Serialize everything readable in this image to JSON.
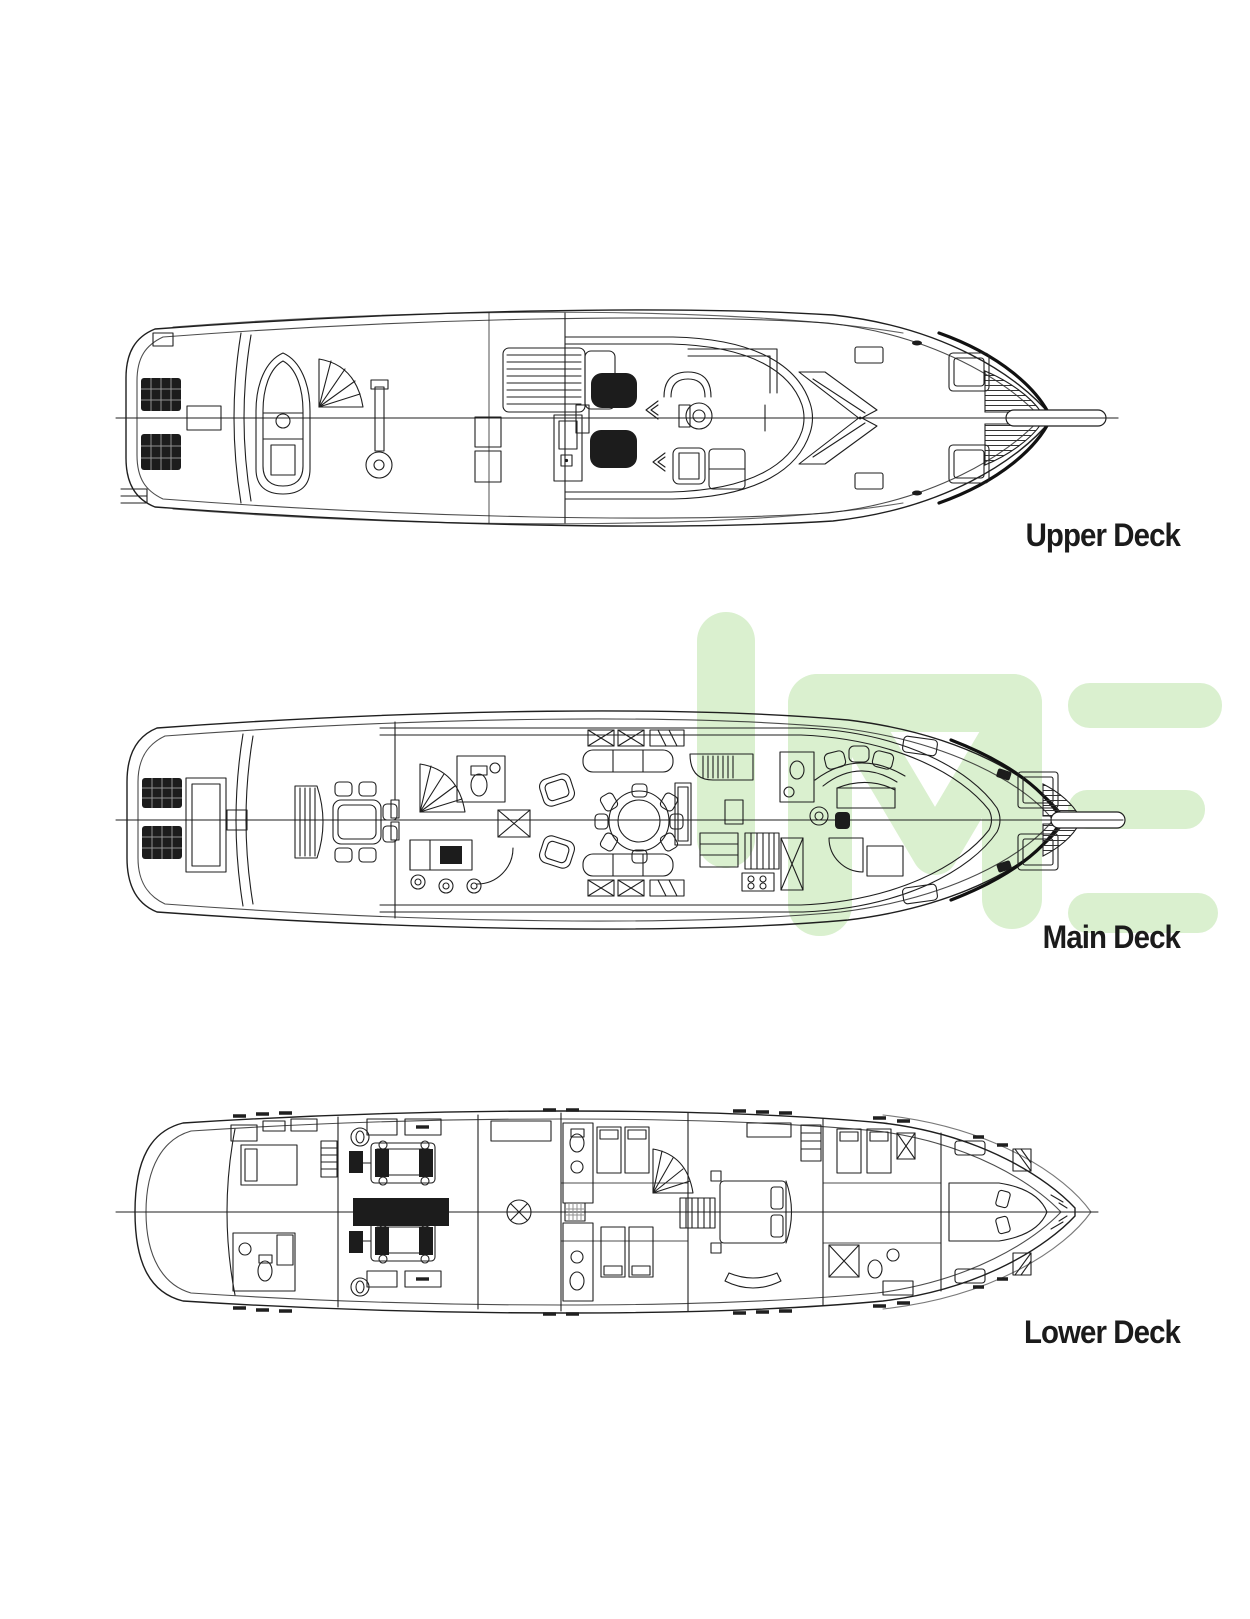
{
  "document": {
    "background_color": "#ffffff",
    "type": "yacht-deck-plan-sheet"
  },
  "watermark": {
    "color": "#daf0cf"
  },
  "drawing": {
    "line_color": "#1f1f1f"
  },
  "decks": [
    {
      "id": "upper-deck",
      "label": "Upper Deck"
    },
    {
      "id": "main-deck",
      "label": "Main Deck"
    },
    {
      "id": "lower-deck",
      "label": "Lower Deck"
    }
  ]
}
